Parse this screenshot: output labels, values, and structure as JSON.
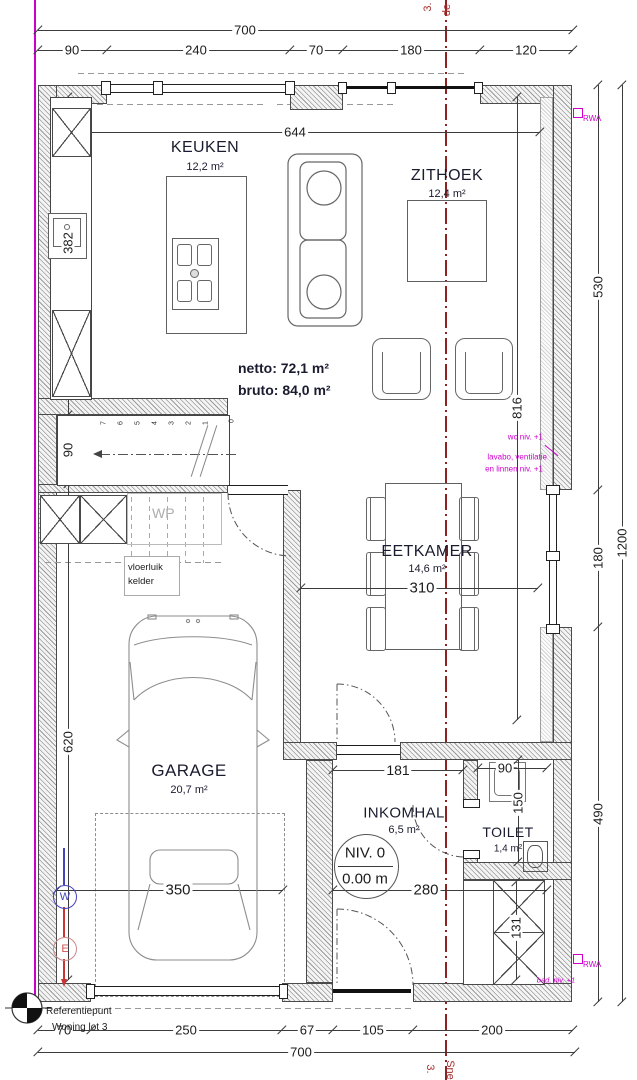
{
  "rooms": {
    "keuken": {
      "name": "KEUKEN",
      "area": "12,2 m²"
    },
    "zithoek": {
      "name": "ZITHOEK",
      "area": "12,4 m²"
    },
    "eetkamer": {
      "name": "EETKAMER",
      "area": "14,6 m²"
    },
    "garage": {
      "name": "GARAGE",
      "area": "20,7 m²"
    },
    "inkomhal": {
      "name": "INKOMHAL",
      "area": "6,5 m²"
    },
    "toilet": {
      "name": "TOILET",
      "area": "1,4 m²"
    }
  },
  "totals": {
    "netto": "netto: 72,1 m²",
    "bruto": "bruto: 84,0 m²"
  },
  "level_marker": {
    "line1": "NIV. 0",
    "line2": "0.00 m"
  },
  "dimensions": {
    "top_total": "700",
    "top_chain": [
      "90",
      "240",
      "70",
      "180",
      "120"
    ],
    "bottom_total": "700",
    "bottom_chain": [
      "70",
      "250",
      "67",
      "105",
      "200"
    ],
    "right_chain": [
      "530",
      "180",
      "490"
    ],
    "right_total": "1200",
    "interior_height": "816",
    "left_chain": [
      "382",
      "90",
      "620"
    ],
    "interior_width": "644",
    "eetkamer_width": "310",
    "garage_width": "350",
    "inkomhal_width": "280",
    "inkomhal_door": "181",
    "toilet_width": "90",
    "toilet_depth": "150",
    "closet_depth": "131"
  },
  "stairs": {
    "treads": [
      "7",
      "6",
      "5",
      "4",
      "3",
      "2",
      "1",
      "0"
    ]
  },
  "annotations": {
    "wp": "WP",
    "vloerluik_line1": "vloerluik",
    "vloerluik_line2": "kelder",
    "wc": "wc niv. +1",
    "lavabo": "lavabo, ventilatie",
    "linnen": "en linnen niv. +1",
    "bad": "bad, niv. +1",
    "rwa": "RWA",
    "referentiepunt": "Referentiepunt",
    "woning_lot": "Woning lot 3",
    "snede_top_1": "3.",
    "snede_top_2": "de",
    "snede_bottom_1": "3.",
    "snede_bottom_2": "Sne"
  },
  "markers": {
    "west": "W",
    "east": "E"
  },
  "colors": {
    "centerline": "#8e2222",
    "property_line": "#cc00cc",
    "annotation_magenta": "#cf00cf",
    "marker_blue": "#4444bb",
    "marker_red": "#cc3333"
  }
}
